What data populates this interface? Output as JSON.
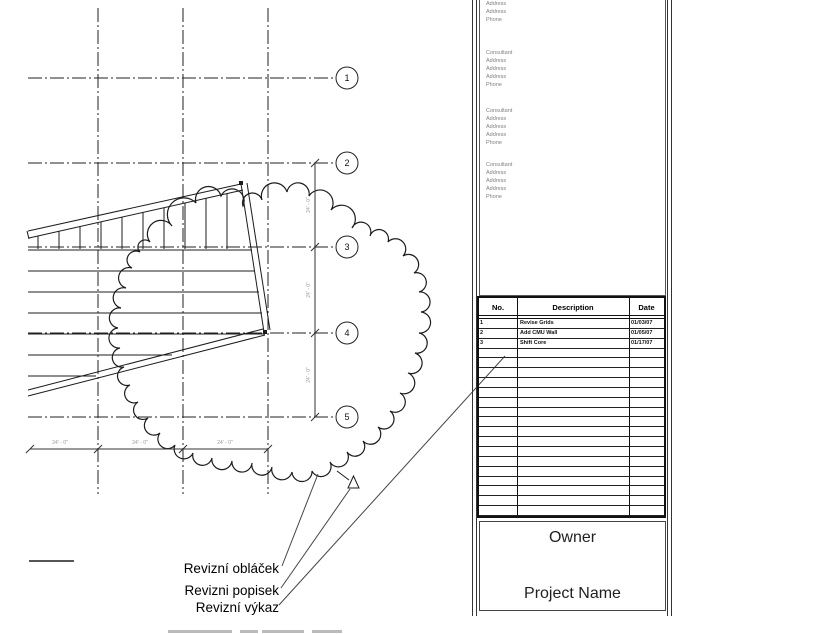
{
  "drawing": {
    "grid_bubbles": [
      {
        "label": "1"
      },
      {
        "label": "2"
      },
      {
        "label": "3"
      },
      {
        "label": "4"
      },
      {
        "label": "5"
      }
    ],
    "dimensions": {
      "vertical": [
        "24' - 0\"",
        "24' - 0\"",
        "24' - 0\""
      ],
      "horizontal": [
        "24' - 0\"",
        "24' - 0\"",
        "24' - 0\""
      ]
    },
    "callout_labels": [
      {
        "text": "Revizní obláček"
      },
      {
        "text": "Revizni popisek"
      },
      {
        "text": "Revizní výkaz"
      }
    ]
  },
  "titleblock": {
    "consultant_blocks": [
      {
        "lines": [
          "Address",
          "Address",
          "Phone"
        ]
      },
      {
        "lines": [
          "Consultant",
          "Address",
          "Address",
          "Address",
          "Phone"
        ]
      },
      {
        "lines": [
          "Consultant",
          "Address",
          "Address",
          "Address",
          "Phone"
        ]
      },
      {
        "lines": [
          "Consultant",
          "Address",
          "Address",
          "Address",
          "Phone"
        ]
      }
    ],
    "revision_table": {
      "headers": [
        "No.",
        "Description",
        "Date"
      ],
      "rows": [
        {
          "no": "1",
          "description": "Revise Grids",
          "date": "01/03/07"
        },
        {
          "no": "2",
          "description": "Add CMU Wall",
          "date": "01/05/07"
        },
        {
          "no": "3",
          "description": "Shift Core",
          "date": "01/17/07"
        }
      ],
      "empty_rows": 17
    },
    "owner_label": "Owner",
    "project_name_label": "Project Name"
  }
}
